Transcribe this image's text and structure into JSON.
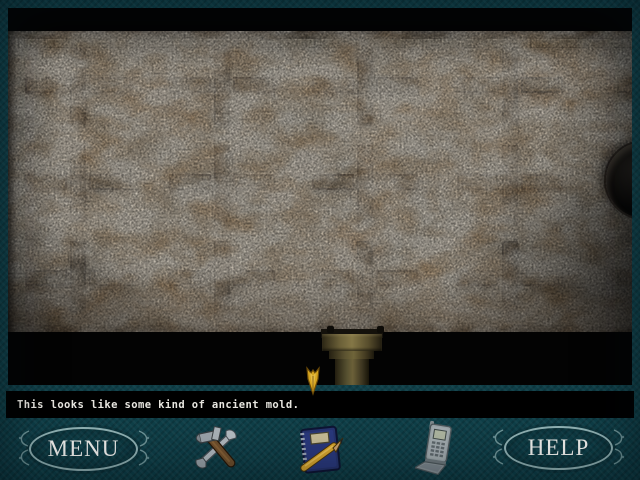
{
  "caption": {
    "text": "This looks like some kind of ancient mold."
  },
  "toolbar": {
    "menu_label": "MENU",
    "help_label": "HELP",
    "icons": [
      {
        "name": "tools-icon"
      },
      {
        "name": "journal-icon"
      },
      {
        "name": "phone-icon"
      }
    ]
  },
  "scene": {
    "name": "ancient-mold-closeup",
    "grid": {
      "rows": [
        54,
        151,
        247
      ],
      "cols": [
        70,
        214,
        357,
        502
      ],
      "partial_arms": [
        {
          "x": 609,
          "cy": 54
        },
        {
          "x": 609,
          "cy": 247
        }
      ]
    },
    "hole": {
      "left": 598,
      "top": 111,
      "size": 76
    }
  },
  "cursor": {
    "left": 304,
    "top": 366
  },
  "colors": {
    "frame_teal": "#0d3c45",
    "oval_stroke": "#8fb0b2",
    "caption_bg": "#000000",
    "caption_text": "#e8e6e0",
    "cursor_gold": "#d6a51f",
    "plate_base": "#978d7b",
    "cross_brown": "#46351f"
  }
}
